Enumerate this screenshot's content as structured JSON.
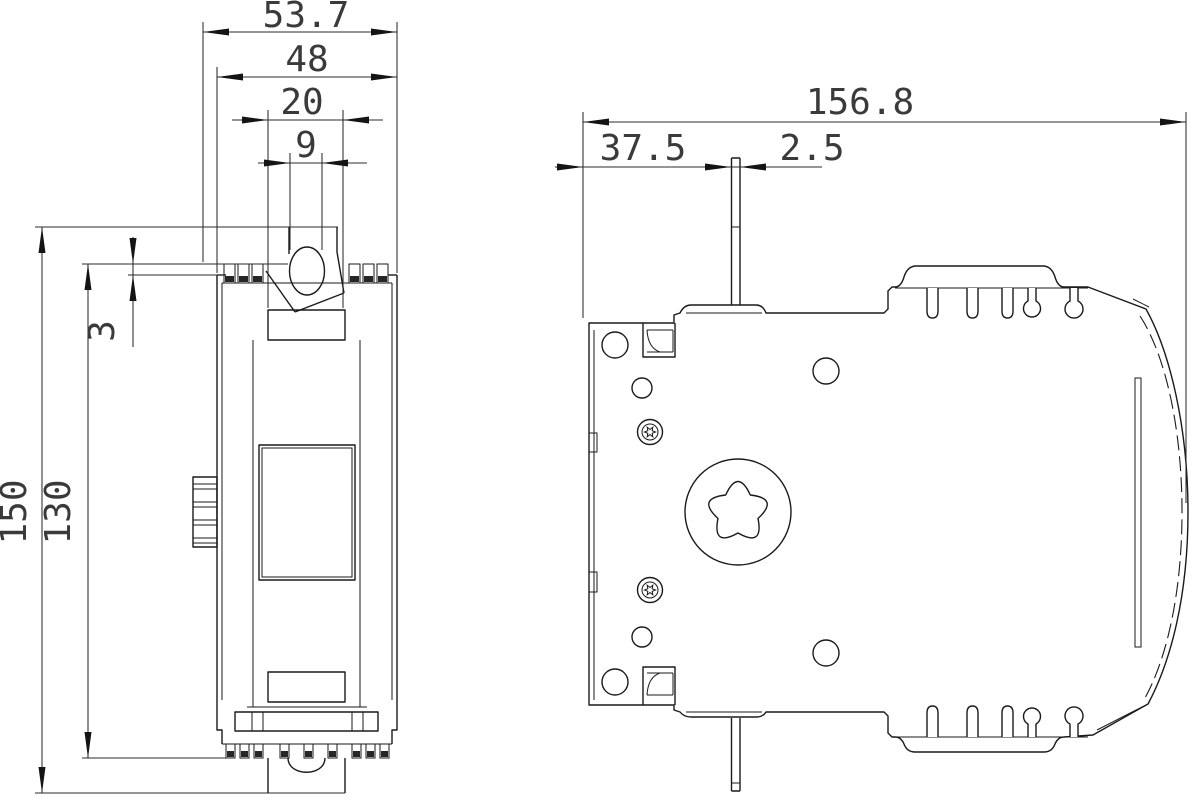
{
  "page": {
    "background": "#ffffff",
    "line_color": "#1a1a1a",
    "text_color": "#3a3a3a"
  },
  "drawing": {
    "type": "2d-engineering-dimension-drawing",
    "views": {
      "front_view": {
        "dimensions_mm": {
          "overall_width": "53.7",
          "body_width": "48",
          "window_width": "20",
          "toggle_hole_width": "9",
          "overall_height": "150",
          "body_height": "130",
          "terminal_step": "3"
        }
      },
      "side_view": {
        "dimensions_mm": {
          "overall_depth": "156.8",
          "rail_pin_offset": "37.5",
          "pin_width": "2.5"
        }
      }
    }
  }
}
